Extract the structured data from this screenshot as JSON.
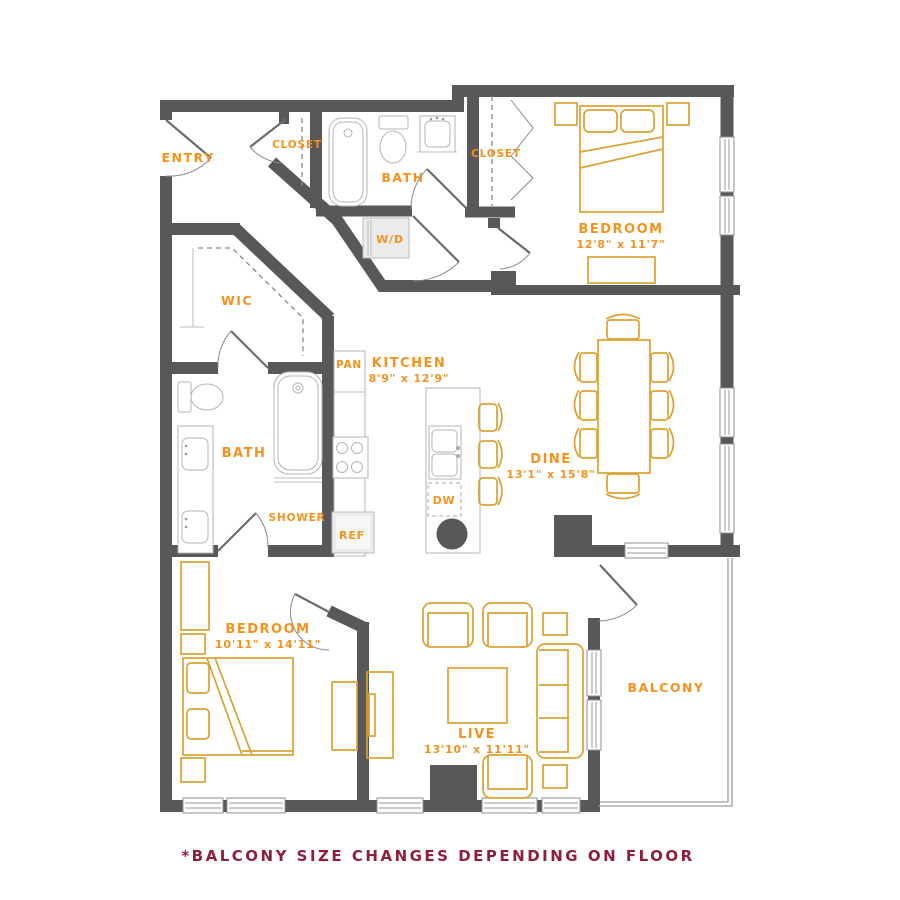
{
  "colors": {
    "wall": "#58585A",
    "room_label": "#F5921E",
    "furniture": "#D9A232",
    "fixture": "#B5B5B5",
    "footnote": "#8E1F3B",
    "background": "#FFFFFF"
  },
  "rooms": {
    "entry": {
      "label": "ENTRY"
    },
    "entry_closet": {
      "label": "CLOSET"
    },
    "hall_bath": {
      "label": "BATH"
    },
    "laundry": {
      "label": "W/D"
    },
    "bedroom_closet": {
      "label": "CLOSET"
    },
    "bedroom_top": {
      "label": "BEDROOM",
      "size": "12'8\" x 11'7\""
    },
    "wic": {
      "label": "WIC"
    },
    "pantry": {
      "label": "PAN"
    },
    "kitchen": {
      "label": "KITCHEN",
      "size": "8'9\" x 12'9\""
    },
    "dining": {
      "label": "DINE",
      "size": "13'1\" x 15'8\""
    },
    "master_bath": {
      "label": "BATH"
    },
    "shower": {
      "label": "SHOWER"
    },
    "fridge": {
      "label": "REF"
    },
    "dishwasher": {
      "label": "DW"
    },
    "bedroom_bottom": {
      "label": "BEDROOM",
      "size": "10'11\" x 14'11\""
    },
    "living": {
      "label": "LIVE",
      "size": "13'10\" x 11'11\""
    },
    "balcony": {
      "label": "BALCONY"
    }
  },
  "footnote": "*BALCONY SIZE CHANGES DEPENDING ON FLOOR"
}
